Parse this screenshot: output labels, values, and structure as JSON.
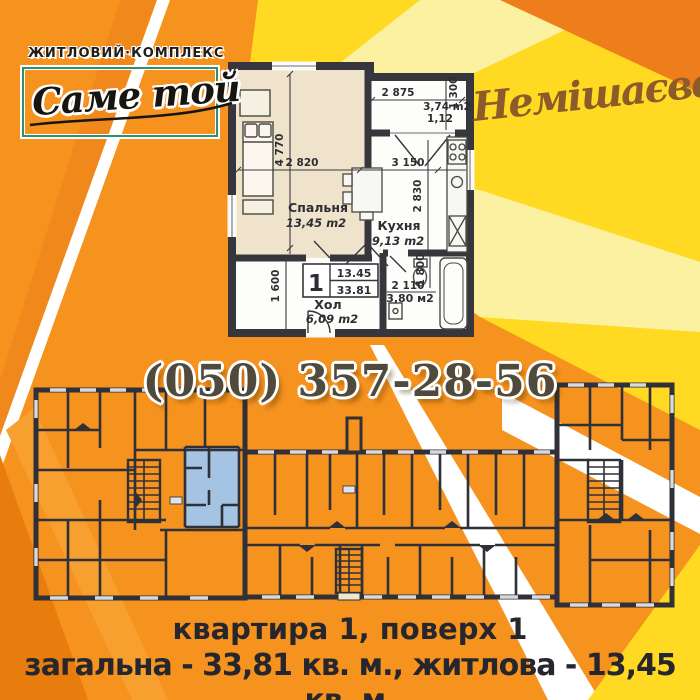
{
  "branding": {
    "complex_label": "житловий·комплекс",
    "brand_name": "Саме той",
    "location": "Немішаєве"
  },
  "contact": {
    "phone": "(050) 357-28-56"
  },
  "footer": {
    "line1": "квартира 1, поверх 1",
    "line2": "загальна - 33,81 кв. м., житлова - 13,45 кв. м."
  },
  "apartment_plan": {
    "unit": {
      "number": "1",
      "living_area": "13.45",
      "total_area": "33.81"
    },
    "rooms": {
      "bedroom": {
        "name": "Спальня",
        "area": "13,45 m2"
      },
      "kitchen": {
        "name": "Кухня",
        "area": "9,13 m2"
      },
      "hall": {
        "name": "Хол",
        "area": "6,09 m2"
      },
      "bathroom": {
        "area": "3,80 м2"
      },
      "balcony": {
        "area": "3,74 m2",
        "coefficient": "1,12"
      }
    },
    "dimensions": {
      "balcony_width": "2 875",
      "balcony_depth": "1 300",
      "kitchen_width": "3 150",
      "kitchen_depth": "2 830",
      "bedroom_depth": "4 770",
      "bedroom_width": "2 820",
      "hall_depth": "1 600",
      "bathroom_width": "2 110",
      "bathroom_depth": "1 800"
    }
  },
  "colors": {
    "base_orange": "#F6921E",
    "deep_orange": "#E87D0E",
    "corner_orange": "#EE7E1B",
    "yellow": "#FFD922",
    "pale_yellow": "#FBF1A0",
    "white_ray": "#FFFFFF",
    "plan_wall": "#2F3038",
    "highlight_apartment": "#A5C3E2",
    "bedroom_floor": "#EFE3CC",
    "brand_brown": "#8B5B2A",
    "text_dark": "#26262E",
    "phone_color": "#4F4A3B"
  }
}
